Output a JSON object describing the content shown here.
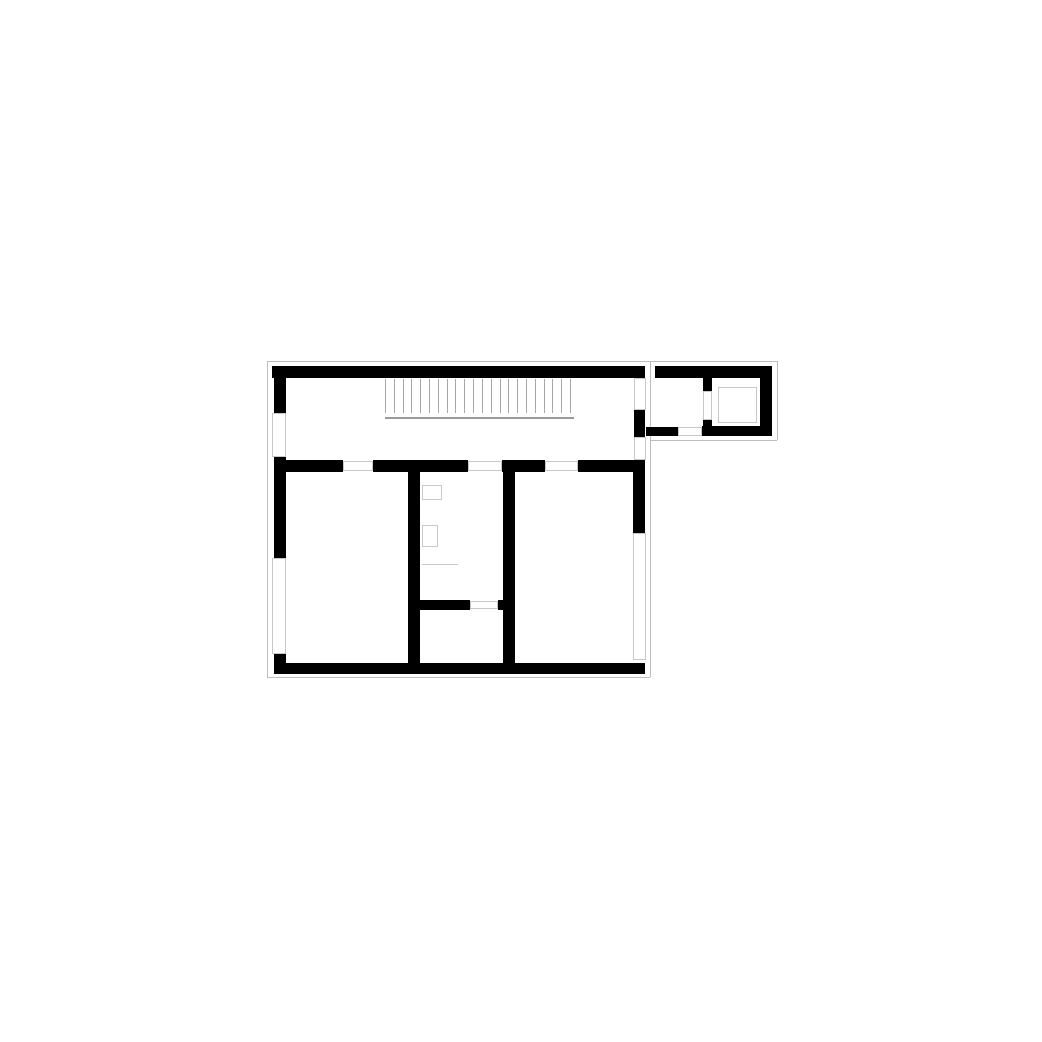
{
  "plan": {
    "canvas": {
      "width": 1042,
      "height": 1042
    },
    "colors": {
      "wall": "#000000",
      "slab_outline": "#bdbdbd",
      "opening_line": "#c7c7c7",
      "fixture_line": "#c9c9c9",
      "stair_line": "#a6a6a6",
      "background": "#ffffff"
    },
    "walls": [
      {
        "name": "corridor-top-wall",
        "x": 272,
        "y": 366,
        "w": 373,
        "h": 12
      },
      {
        "name": "corridor-left-wall",
        "x": 274,
        "y": 366,
        "w": 12,
        "h": 47
      },
      {
        "name": "corridor-right-stub",
        "x": 634,
        "y": 410,
        "w": 11,
        "h": 27
      },
      {
        "name": "annex-top-wall",
        "x": 655,
        "y": 366,
        "w": 117,
        "h": 12
      },
      {
        "name": "annex-right-wall",
        "x": 760,
        "y": 366,
        "w": 12,
        "h": 70
      },
      {
        "name": "annex-bottom-wall",
        "x": 702,
        "y": 426,
        "w": 70,
        "h": 10
      },
      {
        "name": "annex-lobby-bottom-wall",
        "x": 646,
        "y": 427,
        "w": 32,
        "h": 9
      },
      {
        "name": "elevator-room-wall-upper",
        "x": 703,
        "y": 376,
        "w": 9,
        "h": 15
      },
      {
        "name": "elevator-room-wall-lower",
        "x": 703,
        "y": 420,
        "w": 9,
        "h": 16
      },
      {
        "name": "lower-left-wall",
        "x": 274,
        "y": 457,
        "w": 12,
        "h": 101
      },
      {
        "name": "lower-left-wall-corner",
        "x": 274,
        "y": 654,
        "w": 12,
        "h": 20
      },
      {
        "name": "lower-top-wall-seg1",
        "x": 274,
        "y": 460,
        "w": 69,
        "h": 12
      },
      {
        "name": "lower-top-wall-seg2",
        "x": 373,
        "y": 460,
        "w": 95,
        "h": 12
      },
      {
        "name": "lower-top-wall-seg3",
        "x": 502,
        "y": 460,
        "w": 43,
        "h": 12
      },
      {
        "name": "lower-top-wall-seg4",
        "x": 578,
        "y": 460,
        "w": 67,
        "h": 12
      },
      {
        "name": "lower-right-wall",
        "x": 633,
        "y": 460,
        "w": 12,
        "h": 73
      },
      {
        "name": "partition-wall-left",
        "x": 408,
        "y": 460,
        "w": 12,
        "h": 204
      },
      {
        "name": "partition-wall-right",
        "x": 503,
        "y": 460,
        "w": 12,
        "h": 204
      },
      {
        "name": "bathroom-bottom-wall",
        "x": 418,
        "y": 600,
        "w": 52,
        "h": 10
      },
      {
        "name": "bathroom-door-stub",
        "x": 498,
        "y": 600,
        "w": 7,
        "h": 10
      },
      {
        "name": "lower-bottom-wall",
        "x": 274,
        "y": 663,
        "w": 371,
        "h": 11
      }
    ],
    "openings": [
      {
        "name": "window-left-upper",
        "x": 272,
        "y": 413,
        "w": 14,
        "h": 44
      },
      {
        "name": "window-left-lower",
        "x": 272,
        "y": 558,
        "w": 14,
        "h": 96
      },
      {
        "name": "window-corridor-right",
        "x": 634,
        "y": 378,
        "w": 12,
        "h": 32
      },
      {
        "name": "opening-corridor-to-lower",
        "x": 634,
        "y": 437,
        "w": 12,
        "h": 23
      },
      {
        "name": "window-lower-right",
        "x": 633,
        "y": 533,
        "w": 13,
        "h": 127
      },
      {
        "name": "door-room-left",
        "x": 343,
        "y": 461,
        "w": 30,
        "h": 10
      },
      {
        "name": "door-bathroom-top",
        "x": 468,
        "y": 461,
        "w": 34,
        "h": 10
      },
      {
        "name": "door-room-right",
        "x": 545,
        "y": 461,
        "w": 33,
        "h": 10
      },
      {
        "name": "door-bathroom-bottom",
        "x": 470,
        "y": 601,
        "w": 28,
        "h": 8
      },
      {
        "name": "door-annex-lobby",
        "x": 678,
        "y": 427,
        "w": 24,
        "h": 9
      },
      {
        "name": "door-elevator-room",
        "x": 703,
        "y": 391,
        "w": 9,
        "h": 29
      }
    ],
    "fixtures": [
      {
        "name": "elevator-shaft",
        "x": 718,
        "y": 387,
        "w": 39,
        "h": 36
      },
      {
        "name": "bathroom-fixture-1",
        "x": 422,
        "y": 485,
        "w": 20,
        "h": 15
      },
      {
        "name": "bathroom-fixture-2",
        "x": 422,
        "y": 525,
        "w": 16,
        "h": 22
      },
      {
        "name": "bathroom-counter-line",
        "x": 422,
        "y": 564,
        "w": 36,
        "h": 1
      }
    ],
    "stair": {
      "name": "stair-hatch",
      "x": 385,
      "y": 379,
      "width": 185,
      "height": 34,
      "line_count": 22,
      "baseline": {
        "x": 385,
        "y": 417,
        "w": 189,
        "h": 2
      }
    },
    "slab_outline_segments": [
      {
        "name": "outline-top",
        "x1": 267,
        "y1": 361,
        "x2": 777,
        "y2": 361
      },
      {
        "name": "outline-annex-right",
        "x1": 777,
        "y1": 361,
        "x2": 777,
        "y2": 440
      },
      {
        "name": "outline-annex-bottom",
        "x1": 650,
        "y1": 440,
        "x2": 777,
        "y2": 440
      },
      {
        "name": "outline-main-right",
        "x1": 650,
        "y1": 361,
        "x2": 650,
        "y2": 677
      },
      {
        "name": "outline-bottom",
        "x1": 267,
        "y1": 677,
        "x2": 650,
        "y2": 677
      },
      {
        "name": "outline-left",
        "x1": 267,
        "y1": 361,
        "x2": 267,
        "y2": 677
      }
    ]
  }
}
